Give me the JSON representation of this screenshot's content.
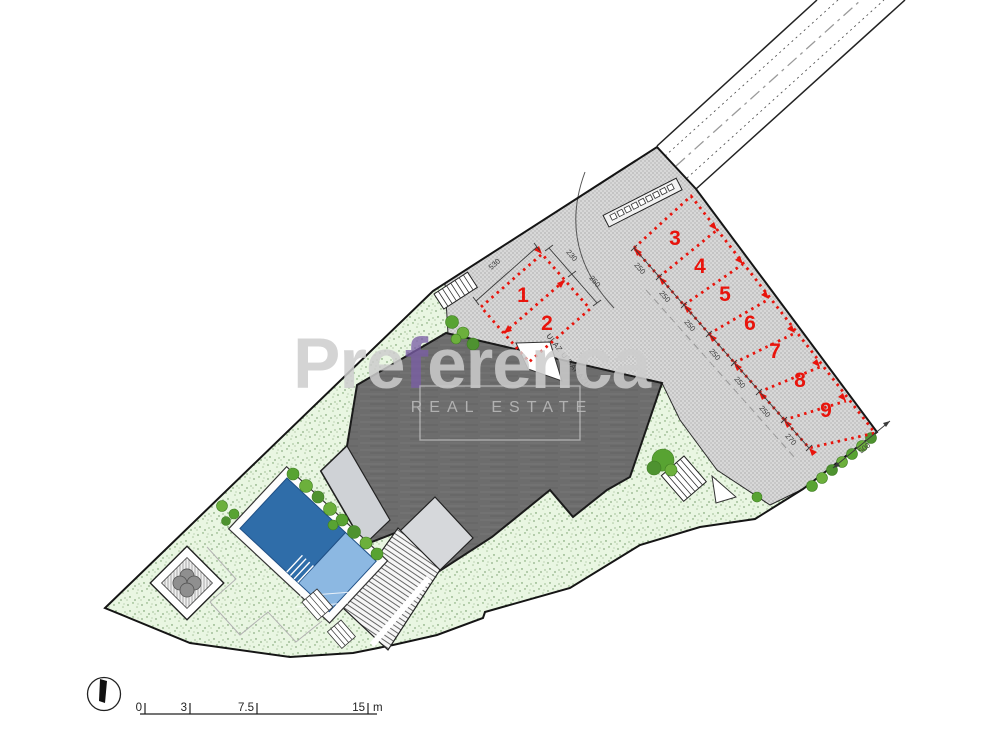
{
  "plan": {
    "title": "residential-site-plan",
    "watermark": {
      "brand_prefix": "Pre",
      "brand_accent_letter": "f",
      "brand_suffix": "erenca",
      "subtitle": "REAL ESTATE",
      "accent_color": "#7b5ea7",
      "text_color": "#cdcdcd"
    },
    "parking_spaces": [
      {
        "number": "1"
      },
      {
        "number": "2"
      },
      {
        "number": "3"
      },
      {
        "number": "4"
      },
      {
        "number": "5"
      },
      {
        "number": "6"
      },
      {
        "number": "7"
      },
      {
        "number": "8"
      },
      {
        "number": "9"
      }
    ],
    "garage_entrance_label": "ULAZ U GARAŽU",
    "dimensions": {
      "block12_length": "530",
      "space1_width": "230",
      "space2_width": "250",
      "chain": [
        "250",
        "250",
        "250",
        "250",
        "250",
        "250",
        "270"
      ],
      "band_depth": "500"
    },
    "scale_bar": {
      "ticks": [
        "0",
        "3",
        "7.5",
        "15"
      ],
      "unit": "m"
    },
    "colors": {
      "parking_marking_red": "#e8140c",
      "roof_gray": "#6d6d6d",
      "pool_deep_blue": "#2f6da9",
      "pool_shallow_blue": "#8cb8e2",
      "lawn_green": "#e9f6e2",
      "hedge_green": "#58a332",
      "paving_gray": "#d8d8d8"
    }
  }
}
